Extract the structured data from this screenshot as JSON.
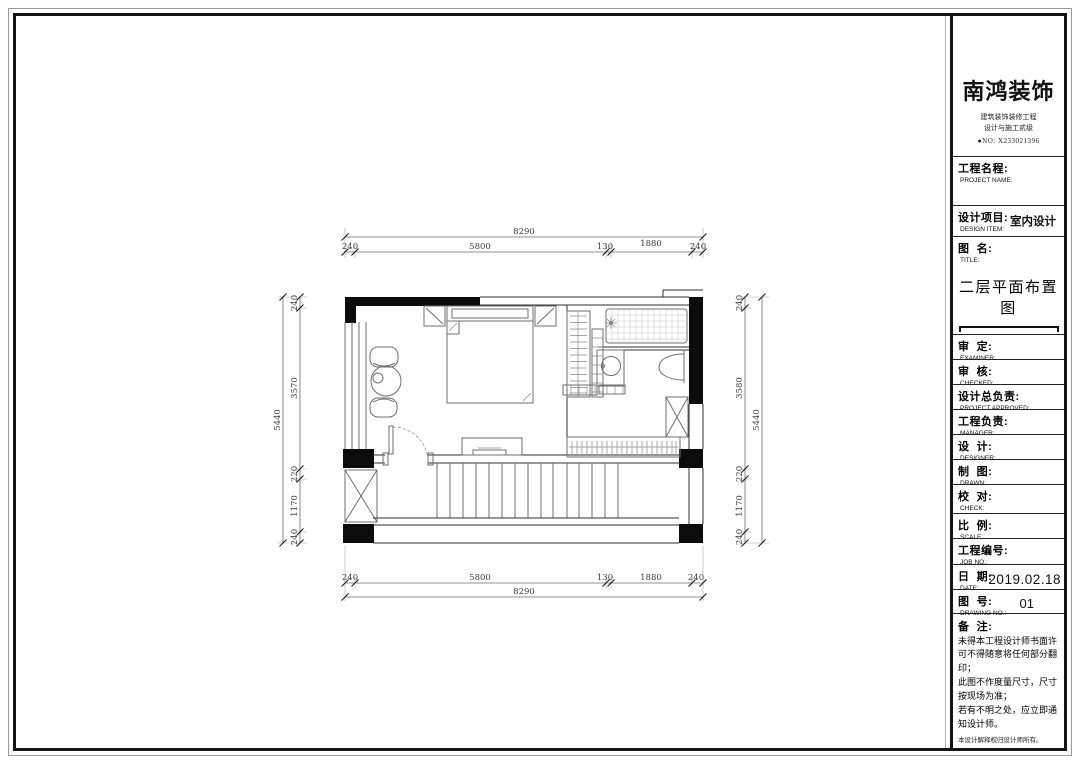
{
  "title_block": {
    "logo": {
      "brand": "南鸿装饰",
      "subtitle1": "建筑装饰装修工程",
      "subtitle2": "设计与施工贰级",
      "license_no": "●NO: X233021396"
    },
    "fields": [
      {
        "label": "工程名程:",
        "sub": "PROJECT NAME:",
        "value": ""
      },
      {
        "label": "设计项目:",
        "sub": "DESIGN ITEM:",
        "value": "室内设计"
      },
      {
        "label": "图  名:",
        "sub": "TITLE:",
        "value": "二层平面布置图"
      },
      {
        "label": "审  定:",
        "sub": "EXAMINER:",
        "value": ""
      },
      {
        "label": "审  核:",
        "sub": "CHECKED:",
        "value": ""
      },
      {
        "label": "设计总负责:",
        "sub": "PROJECT APPROVED:",
        "value": ""
      },
      {
        "label": "工程负责:",
        "sub": "MANAGER:",
        "value": ""
      },
      {
        "label": "设  计:",
        "sub": "DESIGNER:",
        "value": ""
      },
      {
        "label": "制  图:",
        "sub": "DRAWN:",
        "value": ""
      },
      {
        "label": "校  对:",
        "sub": "CHECK:",
        "value": ""
      },
      {
        "label": "比  例:",
        "sub": "SCALE:",
        "value": ""
      },
      {
        "label": "工程编号:",
        "sub": "JOB NO.:",
        "value": ""
      },
      {
        "label": "日  期:",
        "sub": "DATE:",
        "value": "2019.02.18"
      },
      {
        "label": "图  号:",
        "sub": "DRAWING NO.:",
        "value": "01"
      }
    ],
    "notes": {
      "label": "备  注:",
      "lines": [
        "未得本工程设计师书面许可不得随意将任何部分翻印；",
        "此图不作度量尺寸，尺寸按现场为准；",
        "若有不明之处，应立即通知设计师。"
      ],
      "fine_print": "本设计解释权归设计师所有。"
    }
  },
  "plan": {
    "dims": {
      "top": {
        "total": "8290",
        "segments": [
          "240",
          "5800",
          "130",
          "1880",
          "240"
        ]
      },
      "bottom": {
        "total": "8290",
        "segments": [
          "240",
          "5800",
          "130",
          "1880",
          "240"
        ]
      },
      "left": {
        "total": "5440",
        "segments": [
          "240",
          "3570",
          "220",
          "1170",
          "240"
        ]
      },
      "right": {
        "total": "5440",
        "segments": [
          "240",
          "3580",
          "220",
          "1170",
          "240"
        ]
      }
    }
  }
}
